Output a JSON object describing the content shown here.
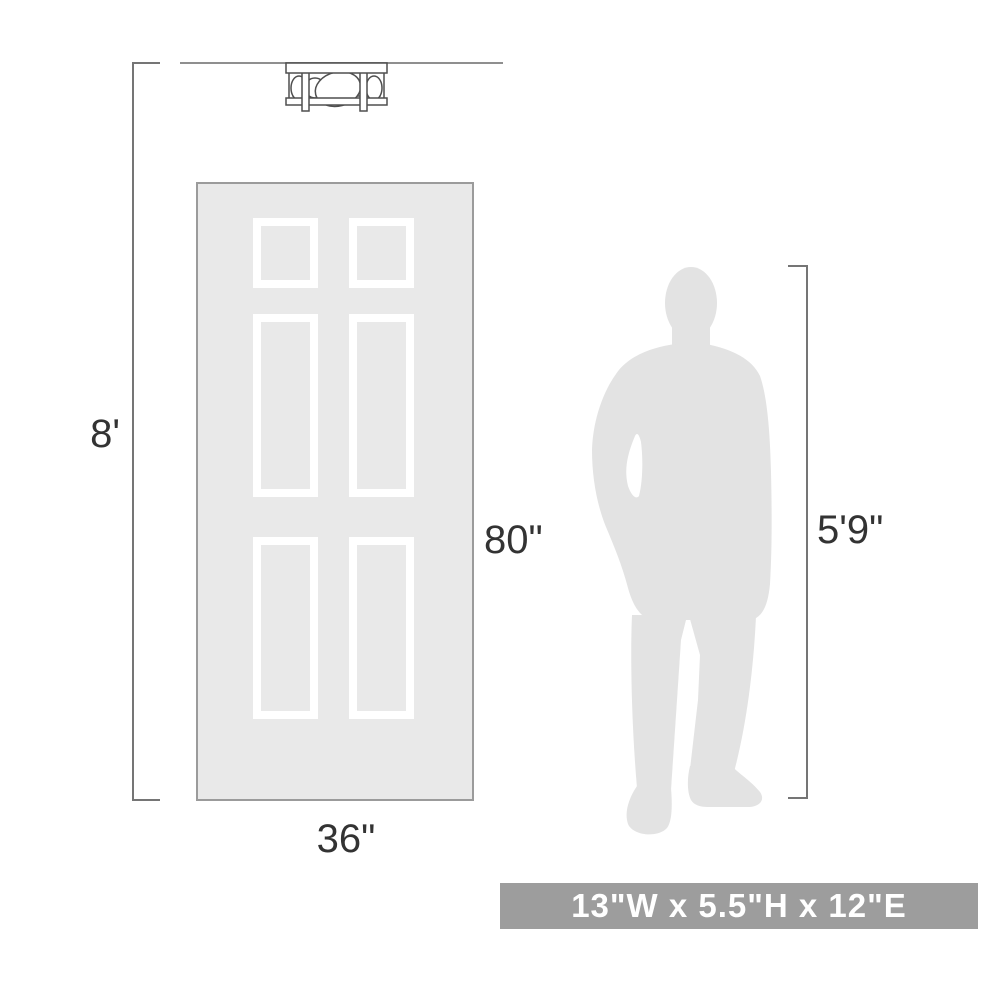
{
  "diagram": {
    "ceiling_height_label": "8'",
    "door_height_label": "80\"",
    "door_width_label": "36\"",
    "person_height_label": "5'9\"",
    "icons": {
      "fixture": "ceiling-light-fixture",
      "door": "six-panel-door",
      "person": "standing-man-silhouette"
    }
  },
  "banner": {
    "text": "13\"W x 5.5\"H x 12\"E"
  },
  "colors": {
    "line_art": "#4f4f4f",
    "dimension_line": "#757575",
    "ceiling_line": "#8f8f8f",
    "door_fill": "#e9e9e9",
    "door_border": "#9b9b9b",
    "panel_frame": "#ffffff",
    "person_fill": "#e3e3e3",
    "label_text": "#333333",
    "banner_bg": "#9d9d9d",
    "banner_text": "#ffffff"
  }
}
